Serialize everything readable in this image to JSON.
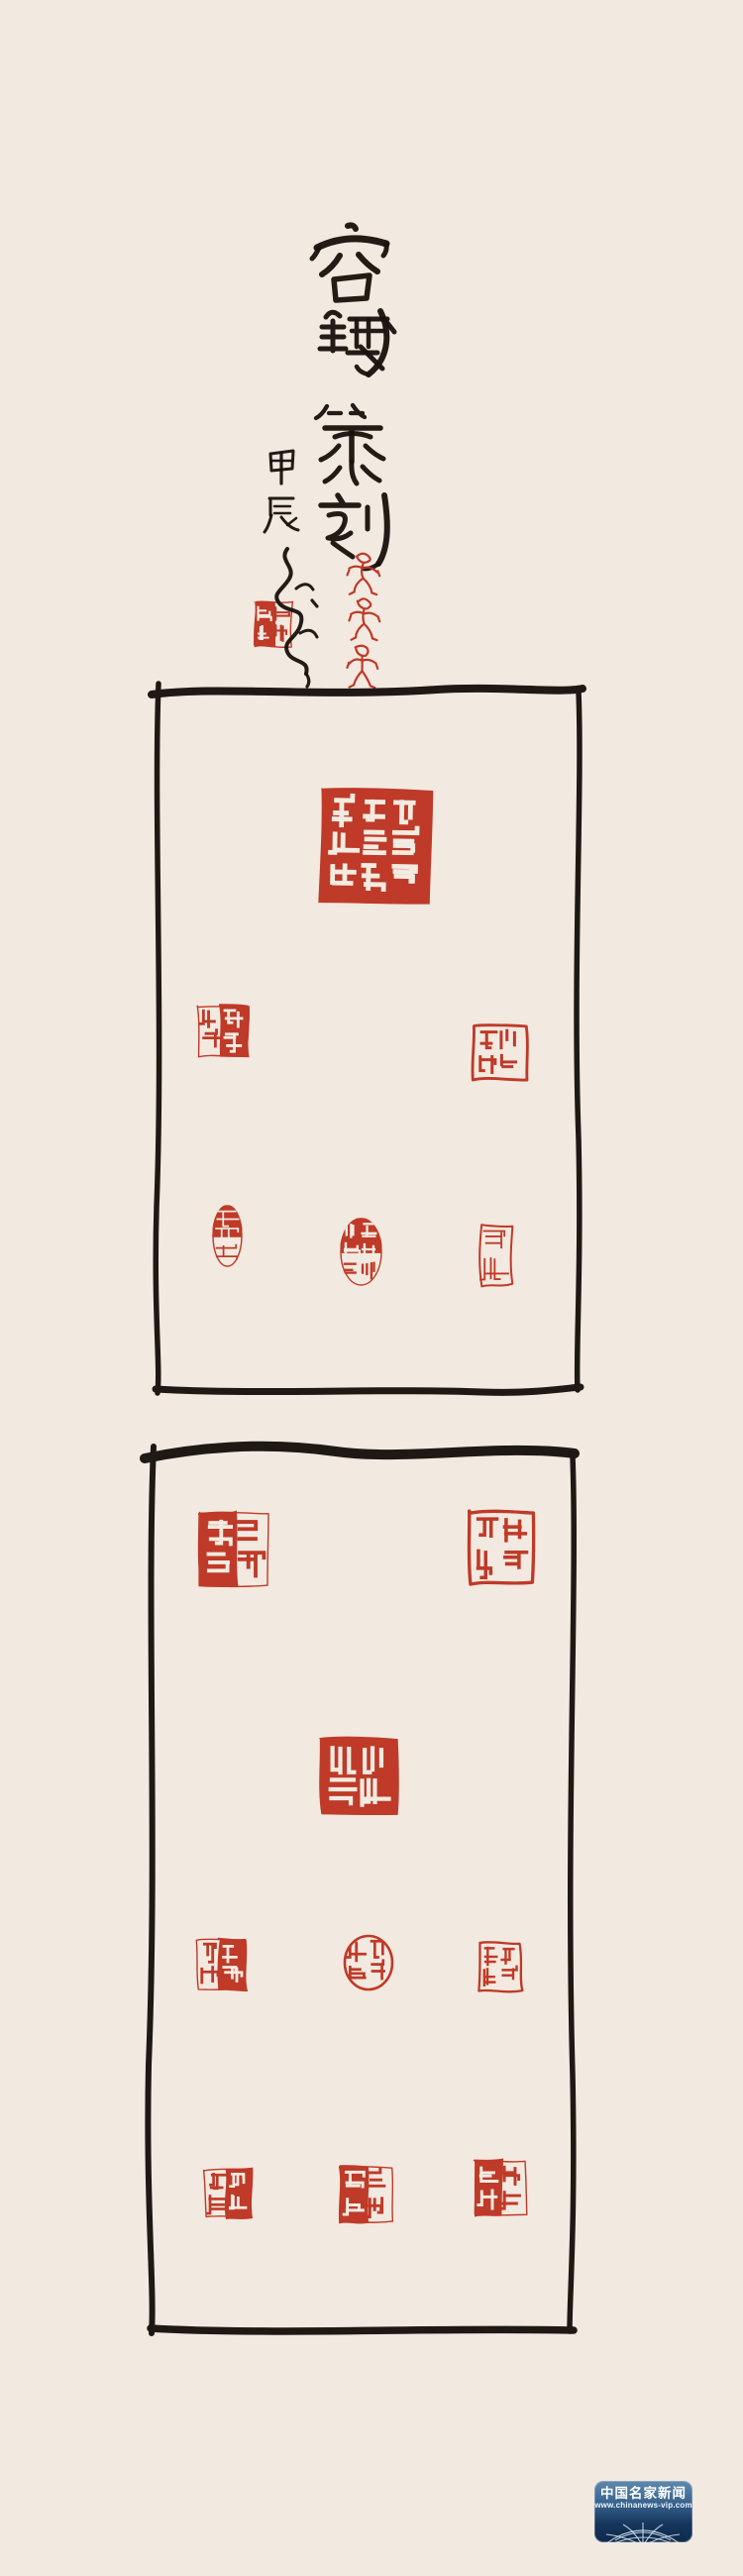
{
  "artwork": {
    "calligraphy": {
      "title": "容鐵篆刻",
      "date": "甲辰",
      "signature": "容鐵"
    },
    "seals": {
      "academy_reading": "中原美術學院",
      "signature_seal_desc": "square artist signature seal, red with white characters",
      "figure_seal_count": 3,
      "figure_seals_desc": "three small red figurative seals stacked vertically",
      "top_panel": [
        "large central square seal reading 中原美術學院 (white on red)",
        "square seal, row 2 left, mixed red/white",
        "square seal, row 2 right, red outline characters",
        "oval seal, row 3 left",
        "oval gourd-shaped seal, row 3 middle",
        "rectangular seal, row 3 right"
      ],
      "bottom_panel": [
        "square seal, row 1 left, mixed red/white",
        "square seal, row 1 right, red outline characters",
        "large square seal, center, white on red",
        "square seal, row 2 left",
        "round seal, row 2 middle",
        "rectangular seal, row 2 right",
        "square seal, row 3 left",
        "square seal, row 3 middle",
        "square seal, row 3 right"
      ]
    }
  },
  "watermark": {
    "title": "中国名家新闻",
    "url": "www.chinanews-vip.com"
  },
  "colors": {
    "paper": "#f2e9e0",
    "ink": "#1f1914",
    "seal_red": "#bd3321",
    "watermark_blue_top": "#6089ad",
    "watermark_blue_bottom": "#0e2a4c"
  }
}
